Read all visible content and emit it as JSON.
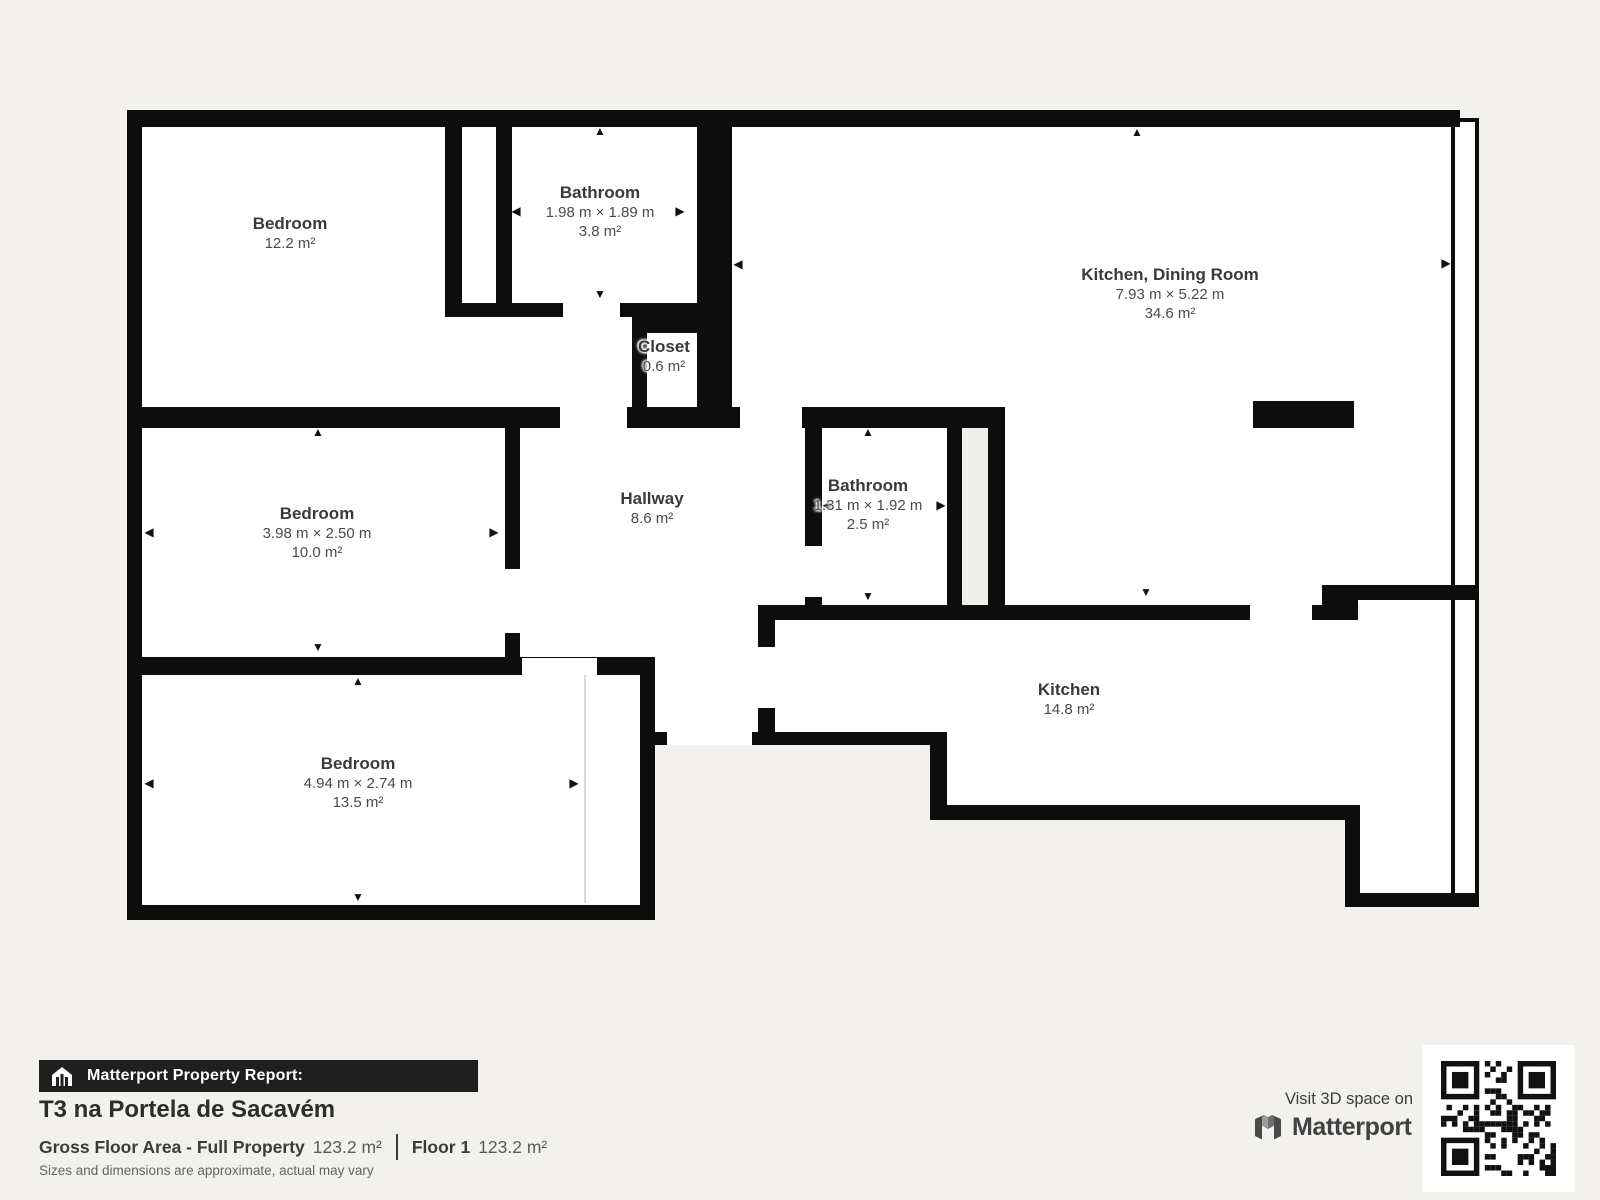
{
  "report": {
    "bar_label": "Matterport Property Report:",
    "title": "T3 na Portela de Sacavém",
    "gross_floor_area_label": "Gross Floor Area - Full Property",
    "gross_floor_area_value": "123.2 m²",
    "floor_label": "Floor 1",
    "floor_value": "123.2 m²",
    "disclaimer": "Sizes and dimensions are approximate, actual may vary"
  },
  "cta": {
    "visit_text": "Visit 3D space on",
    "brand": "Matterport"
  },
  "rooms": {
    "bedroom1": {
      "name": "Bedroom",
      "area": "12.2 m²"
    },
    "bathroom1": {
      "name": "Bathroom",
      "dims": "1.98 m × 1.89 m",
      "area": "3.8 m²"
    },
    "kitchen_dining": {
      "name": "Kitchen, Dining Room",
      "dims": "7.93 m × 5.22 m",
      "area": "34.6 m²"
    },
    "closet": {
      "name": "Closet",
      "area": "0.6 m²"
    },
    "bedroom2": {
      "name": "Bedroom",
      "dims": "3.98 m × 2.50 m",
      "area": "10.0 m²"
    },
    "hallway": {
      "name": "Hallway",
      "area": "8.6 m²"
    },
    "bathroom2": {
      "name": "Bathroom",
      "dims": "1.31 m × 1.92 m",
      "area": "2.5 m²"
    },
    "bedroom3": {
      "name": "Bedroom",
      "dims": "4.94 m × 2.74 m",
      "area": "13.5 m²"
    },
    "kitchen": {
      "name": "Kitchen",
      "area": "14.8 m²"
    }
  },
  "colors": {
    "background": "#f2f1ee",
    "wall": "#0d0d0d",
    "room_fill": "#ffffff",
    "text": "#3c3c3c",
    "report_bar": "#1f1f1f"
  }
}
